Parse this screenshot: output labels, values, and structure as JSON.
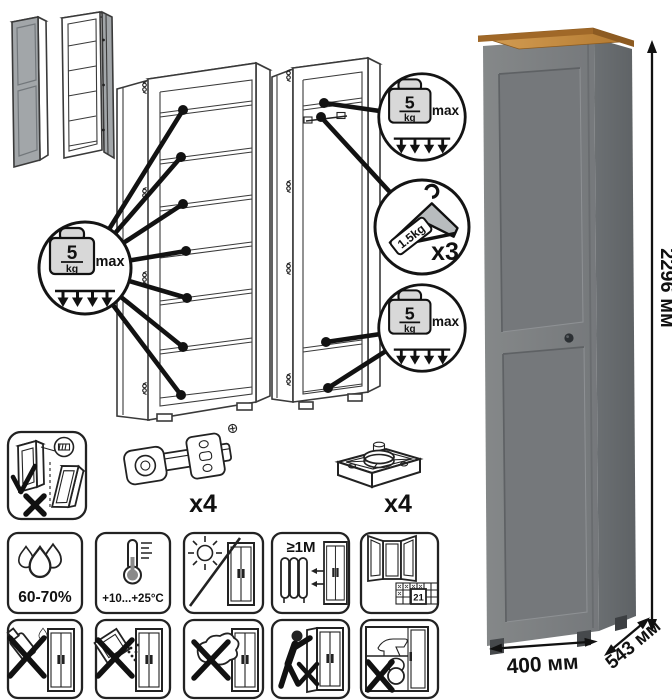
{
  "load_badge": {
    "value": "5",
    "unit": "kg",
    "max": "max"
  },
  "hanger_badge": {
    "weight": "1.5kg",
    "count": "x3"
  },
  "hardware": {
    "hinge_count": "x4",
    "foot_count": "x4"
  },
  "care": {
    "humidity": "60-70%",
    "temperature": "+10...+25°C",
    "min_distance": "≥1M",
    "vent_day": "21"
  },
  "dimensions": {
    "height": "2296 мм",
    "width": "400 мм",
    "depth": "543 мм"
  },
  "colors": {
    "wood_top": "#c08038",
    "cabinet_front": "#7d8083",
    "cabinet_side": "#686c6f",
    "line_art": "#3a3a3a"
  }
}
